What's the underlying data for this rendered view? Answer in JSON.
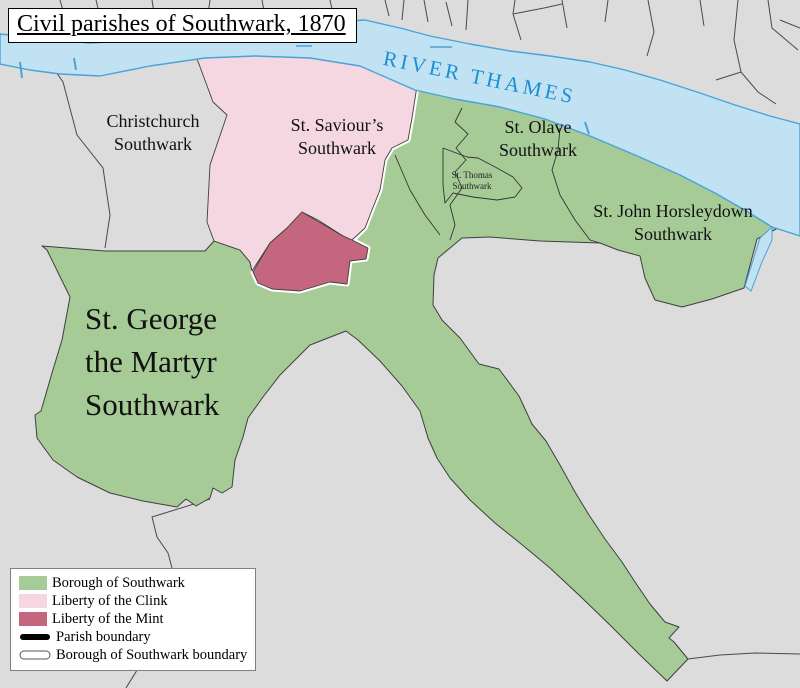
{
  "title": "Civil parishes of Southwark, 1870",
  "river": {
    "label": "RIVER THAMES",
    "text_color": "#1b8fd4"
  },
  "parishes": {
    "christchurch": {
      "line1": "Christchurch",
      "line2": "Southwark"
    },
    "st_saviours": {
      "line1": "St. Saviour’s",
      "line2": "Southwark"
    },
    "st_olave": {
      "line1": "St. Olave",
      "line2": "Southwark"
    },
    "st_thomas": {
      "line1": "St. Thomas",
      "line2": "Southwark"
    },
    "st_john": {
      "line1": "St. John Horsleydown",
      "line2": "Southwark"
    },
    "st_george": {
      "line1": "St. George",
      "line2": "the Martyr",
      "line3": "Southwark"
    }
  },
  "legend": {
    "items": [
      {
        "label": "Borough of Southwark"
      },
      {
        "label": "Liberty of the Clink"
      },
      {
        "label": "Liberty of the Mint"
      },
      {
        "label": "Parish boundary"
      },
      {
        "label": "Borough of Southwark boundary"
      }
    ]
  },
  "colors": {
    "borough_green": "#a6cb97",
    "clink_pink": "#f4d7e0",
    "mint_red": "#c4677e",
    "land_gray": "#dcdcdc",
    "river_blue": "#c0e2f2",
    "shore_blue": "#4aa3d8",
    "boundary_dark": "#424242",
    "borough_boundary_white": "#ffffff",
    "parish_boundary_black": "#000000"
  }
}
